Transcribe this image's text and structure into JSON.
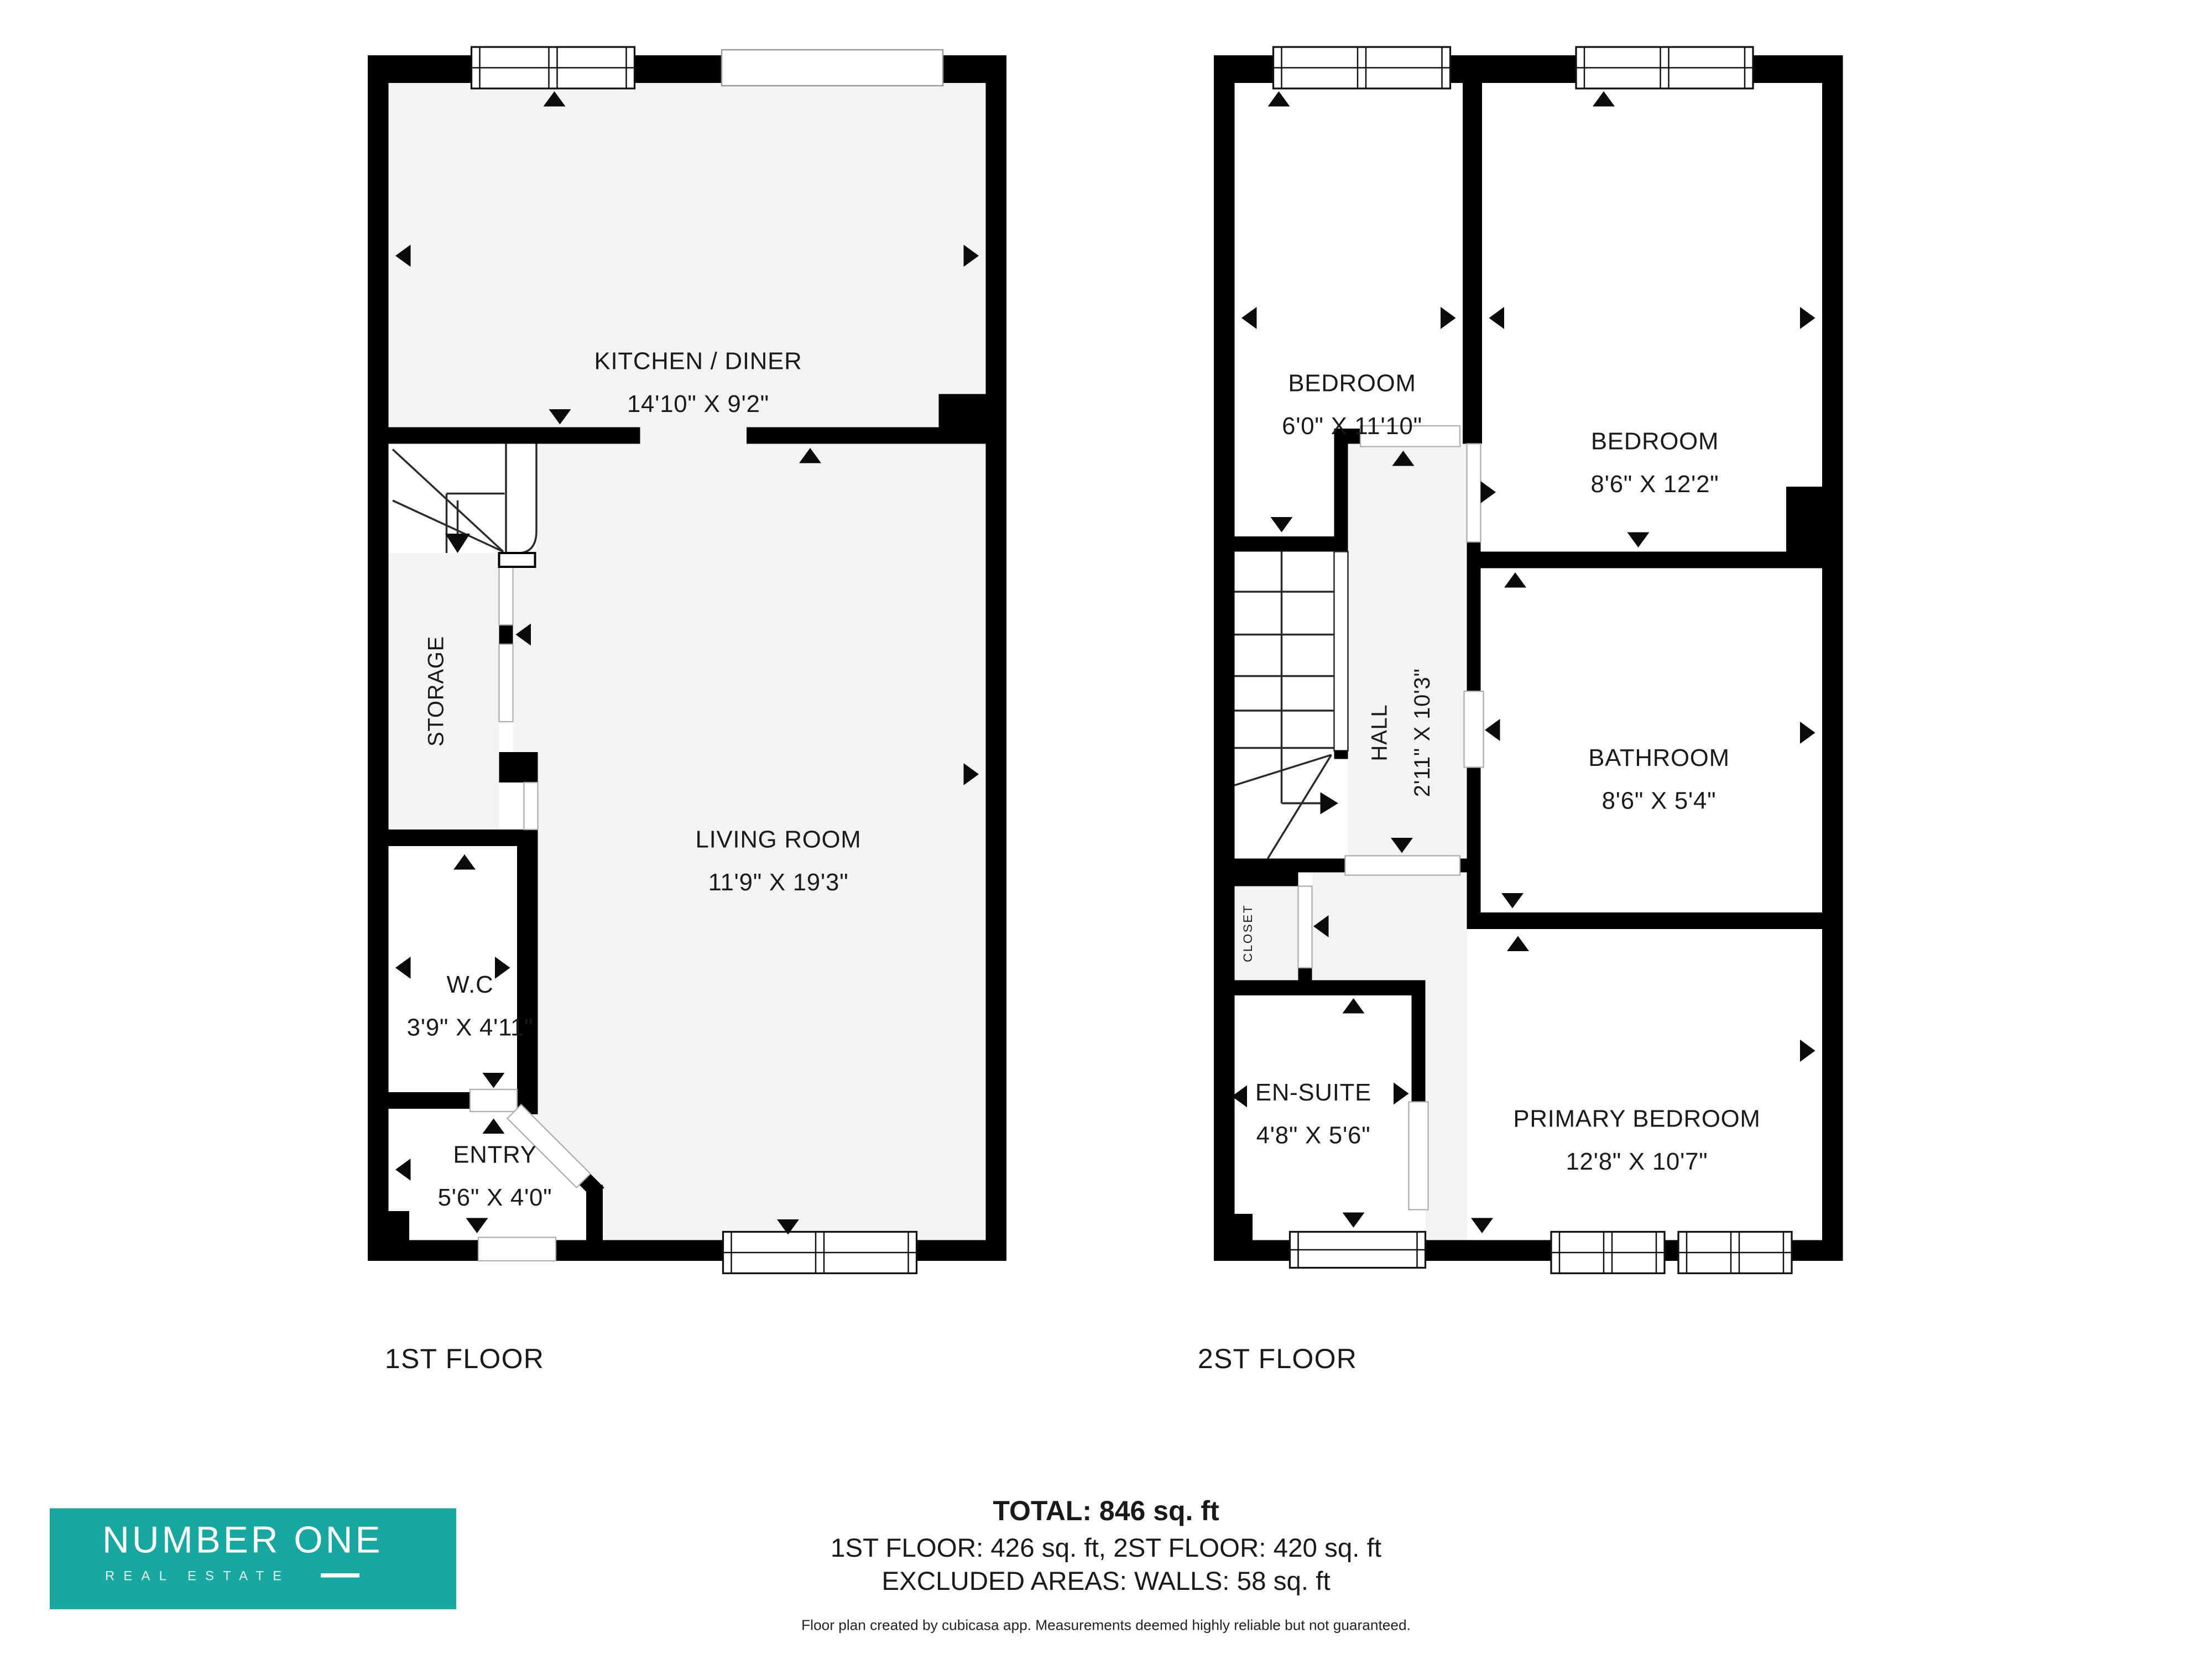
{
  "document": {
    "type": "floor-plan"
  },
  "floors": [
    {
      "title": "1ST FLOOR",
      "rooms": [
        {
          "name": "KITCHEN / DINER",
          "dims": "14'10\" X 9'2\""
        },
        {
          "name": "LIVING ROOM",
          "dims": "11'9\" X 19'3\""
        },
        {
          "name": "STORAGE",
          "dims": ""
        },
        {
          "name": "W.C",
          "dims": "3'9\" X 4'11\""
        },
        {
          "name": "ENTRY",
          "dims": "5'6\" X 4'0\""
        }
      ]
    },
    {
      "title": "2ST FLOOR",
      "rooms": [
        {
          "name": "BEDROOM",
          "dims": "6'0\" X 11'10\""
        },
        {
          "name": "BEDROOM",
          "dims": "8'6\" X 12'2\""
        },
        {
          "name": "HALL",
          "dims": "2'11\" X 10'3\""
        },
        {
          "name": "BATHROOM",
          "dims": "8'6\" X 5'4\""
        },
        {
          "name": "CLOSET",
          "dims": ""
        },
        {
          "name": "EN-SUITE",
          "dims": "4'8\" X 5'6\""
        },
        {
          "name": "PRIMARY BEDROOM",
          "dims": "12'8\" X 10'7\""
        }
      ]
    }
  ],
  "summary": {
    "total": "TOTAL: 846 sq. ft",
    "floors_line": "1ST FLOOR: 426 sq. ft, 2ST FLOOR: 420 sq. ft",
    "excluded_line": "EXCLUDED AREAS: WALLS: 58 sq. ft",
    "disclaimer": "Floor plan created by cubicasa app. Measurements deemed highly reliable but not guaranteed."
  },
  "logo": {
    "name": "NUMBER ONE",
    "subtitle": "REAL ESTATE",
    "background": "#17A8A2",
    "text_color": "#FFFFFF"
  },
  "colors": {
    "wall": "#000000",
    "floor": "#F3F3F3",
    "background": "#FFFFFF",
    "text": "#1A1A1A"
  }
}
